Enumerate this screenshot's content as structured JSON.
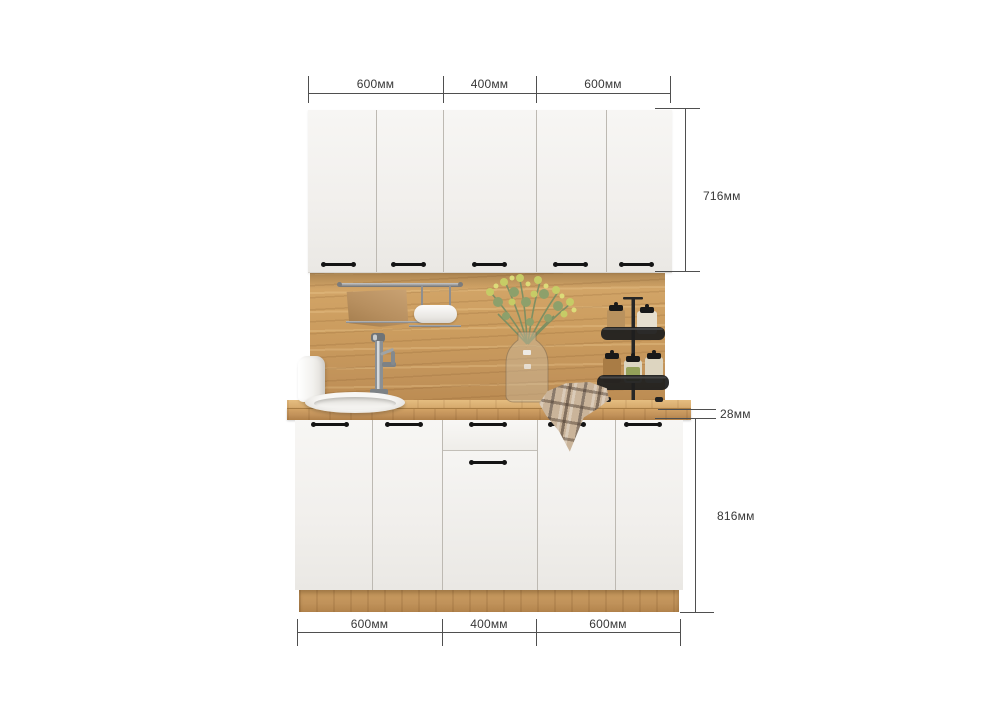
{
  "dimensions": {
    "top": [
      {
        "label": "600мм"
      },
      {
        "label": "400мм"
      },
      {
        "label": "600мм"
      }
    ],
    "bottom": [
      {
        "label": "600мм"
      },
      {
        "label": "400мм"
      },
      {
        "label": "600мм"
      }
    ],
    "upper_cabinet_height": {
      "label": "716мм"
    },
    "countertop_thickness": {
      "label": "28мм"
    },
    "base_cabinet_height": {
      "label": "816мм"
    }
  },
  "colors": {
    "background": "#ffffff",
    "cabinet_front": "#f2f0ec",
    "wood": "#c99c5f",
    "handle": "#141414",
    "dimension_line": "#4f4f4f",
    "label_text": "#383838"
  },
  "scene": {
    "type": "kitchen-set-dimension-render",
    "upper_door_count": 5,
    "lower_front_layout": [
      "door",
      "door",
      "drawer-over-door",
      "door",
      "door"
    ],
    "decor_items": [
      "hanging-rail",
      "kitchen-towel",
      "paper-towel-holder",
      "faucet",
      "soap-dispenser",
      "round-sink",
      "flower-vase",
      "spice-rack",
      "plaid-towel"
    ]
  }
}
